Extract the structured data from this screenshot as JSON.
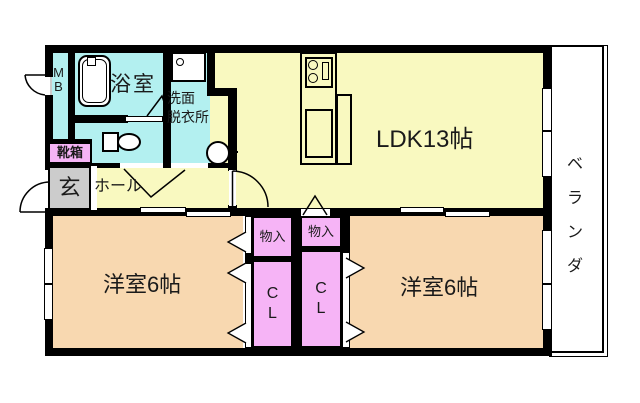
{
  "floorplan": {
    "title": "apartment-floor-plan",
    "rooms": {
      "ldk": {
        "label": "LDK13帖"
      },
      "bedroom1": {
        "label": "洋室6帖"
      },
      "bedroom2": {
        "label": "洋室6帖"
      },
      "bath": {
        "label": "浴室"
      },
      "washroom": {
        "label": "洗面\n脱衣所"
      },
      "hall": {
        "label": "ホール"
      },
      "entrance": {
        "label": "玄"
      },
      "shoebox": {
        "label": "靴箱"
      },
      "meterbox": {
        "label": "MB"
      },
      "veranda": {
        "label": "ベランダ"
      },
      "storage1": {
        "label": "物入"
      },
      "storage2": {
        "label": "物入"
      },
      "closet1": {
        "label": "CL"
      },
      "closet2": {
        "label": "CL"
      }
    },
    "colors": {
      "living_yellow": "#f9f9c0",
      "wet_cyan": "#b3f0f0",
      "bedroom_tan": "#f8d8b0",
      "closet_pink": "#f6b4f6",
      "utility_gray": "#cccccc",
      "wall_black": "#000000",
      "background_white": "#ffffff"
    },
    "icons": [
      "bathtub-icon",
      "toilet-icon",
      "washbasin-icon",
      "washing-machine-pan-icon",
      "stove-icon",
      "kitchen-sink-icon",
      "door-arc-icon",
      "folding-door-icon",
      "sliding-door-icon"
    ]
  }
}
